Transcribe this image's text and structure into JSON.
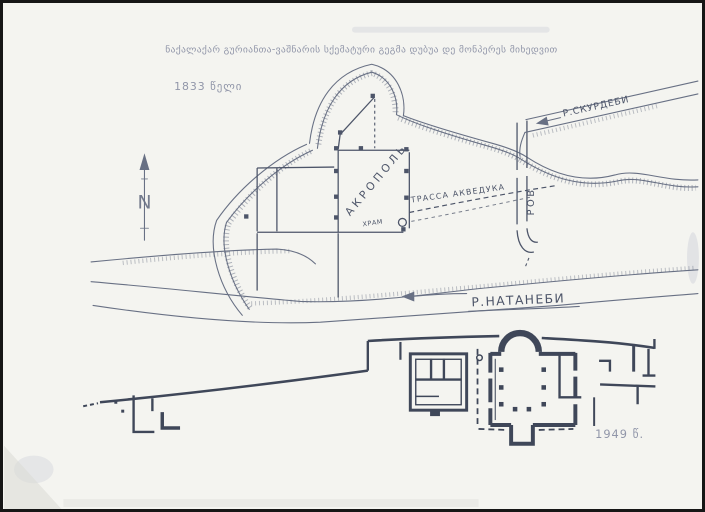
{
  "scan": {
    "title": "ნაქალაქარ გურიანთა-ვაშნარის სქემატური გეგმა დუბუა დე მონპერეს მიხედვით",
    "map_1833": {
      "year_label": "1833 წელი",
      "compass_label": "N",
      "acropolis_label": "АКРОПОЛЬ",
      "temple_label": "ХРАМ",
      "aqueduct_label": "ТРАССА АКВЕДУКА",
      "moat_label": "РОВ",
      "natanebi_label": "Р.НАТАНЕБИ",
      "skurdebi_label": "Р.СКУРДЕБИ"
    },
    "plan_1949": {
      "year_label": "1949 წ."
    },
    "colors": {
      "paper": "#f4f4f0",
      "frame": "#161616",
      "ink_map": "#687084",
      "ink_labels": "#4d5569",
      "ink_plan": "#3f4759",
      "ink_faint": "#9196a9"
    }
  }
}
